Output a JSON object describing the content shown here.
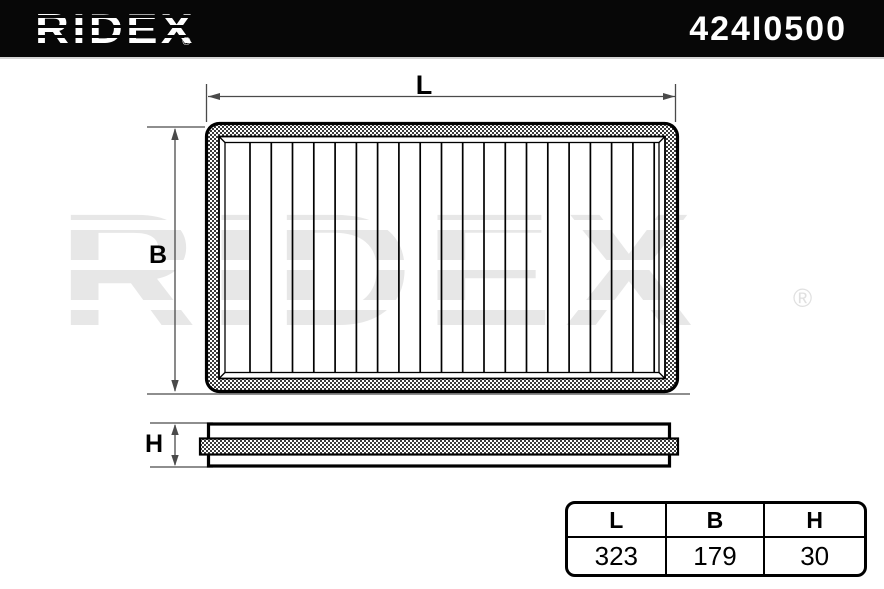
{
  "header": {
    "brand": "RIDEX",
    "registered_mark": "®",
    "part_number": "424I0500"
  },
  "watermark": {
    "brand": "RIDEX",
    "registered_mark": "®"
  },
  "diagram": {
    "length_label": "L",
    "width_label": "B",
    "height_label": "H"
  },
  "dimensions_table": {
    "headers": [
      "L",
      "B",
      "H"
    ],
    "values": [
      "323",
      "179",
      "30"
    ]
  },
  "colors": {
    "header_background": "#070707",
    "header_text": "#ffffff",
    "watermark_gray": "#e7e7e7",
    "outline_black": "#000000",
    "dimension_line_gray": "#4a4a4a",
    "hatch_dark": "#3a3a3a"
  }
}
